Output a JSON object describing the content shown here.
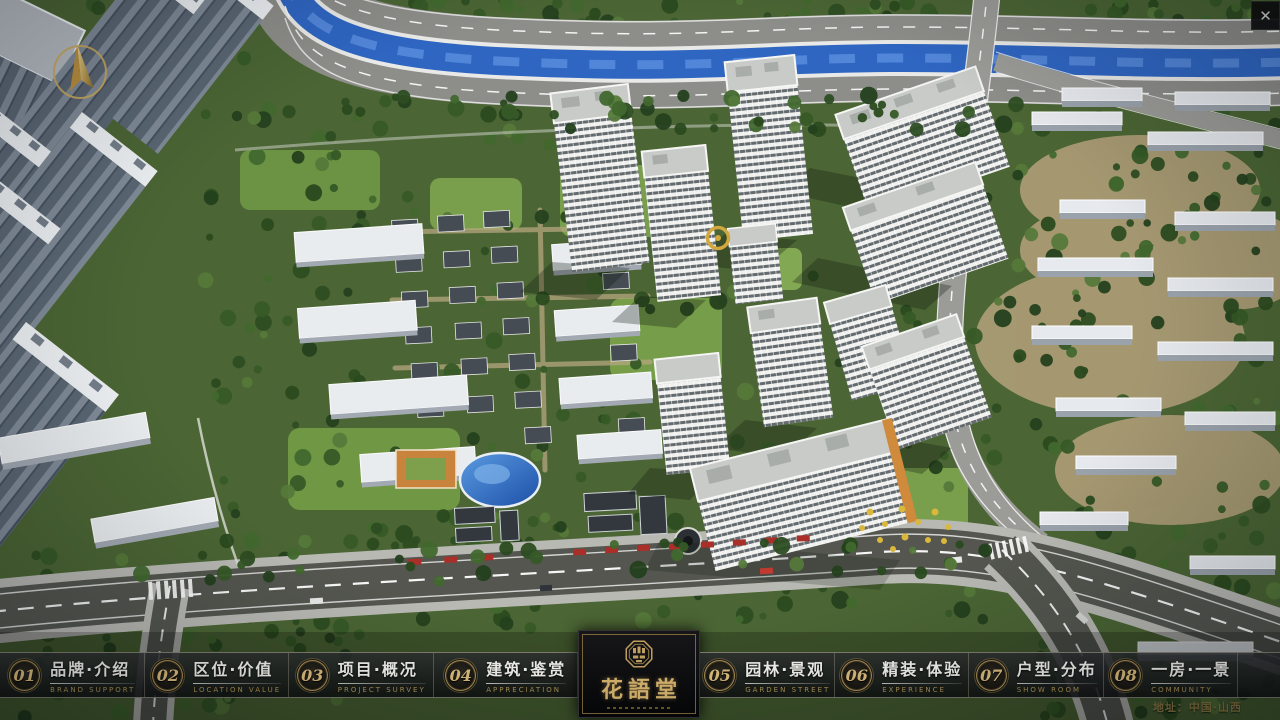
{
  "window": {
    "close": "✕"
  },
  "icons": {
    "close": "x-close-icon",
    "compass": "gold-north-arrow"
  },
  "nav": {
    "items": [
      {
        "num": "01",
        "zh": "品牌·介绍",
        "en": "BRAND SUPPORT"
      },
      {
        "num": "02",
        "zh": "区位·价值",
        "en": "LOCATION VALUE"
      },
      {
        "num": "03",
        "zh": "项目·概况",
        "en": "PROJECT SURVEY"
      },
      {
        "num": "04",
        "zh": "建筑·鉴赏",
        "en": "APPRECIATION"
      },
      {
        "num": "05",
        "zh": "园林·景观",
        "en": "GARDEN STREET"
      },
      {
        "num": "06",
        "zh": "精装·体验",
        "en": "EXPERIENCE"
      },
      {
        "num": "07",
        "zh": "户型·分布",
        "en": "SHOW ROOM"
      },
      {
        "num": "08",
        "zh": "一房·一景",
        "en": "COMMUNITY"
      }
    ]
  },
  "logo": {
    "name": "花語堂"
  },
  "footer": {
    "address": "地址：中国·山西"
  },
  "colors": {
    "gold": "#c9a86a",
    "gold_dim": "#ab9055",
    "bar_bg": "#101114",
    "panel_bg": "#0b0b0c",
    "text": "#f2f2ee",
    "river": "#2f66c2",
    "asphalt": "#54564f",
    "tree_dark": "#2e4a24",
    "roof_light": "#c8cbc7"
  }
}
